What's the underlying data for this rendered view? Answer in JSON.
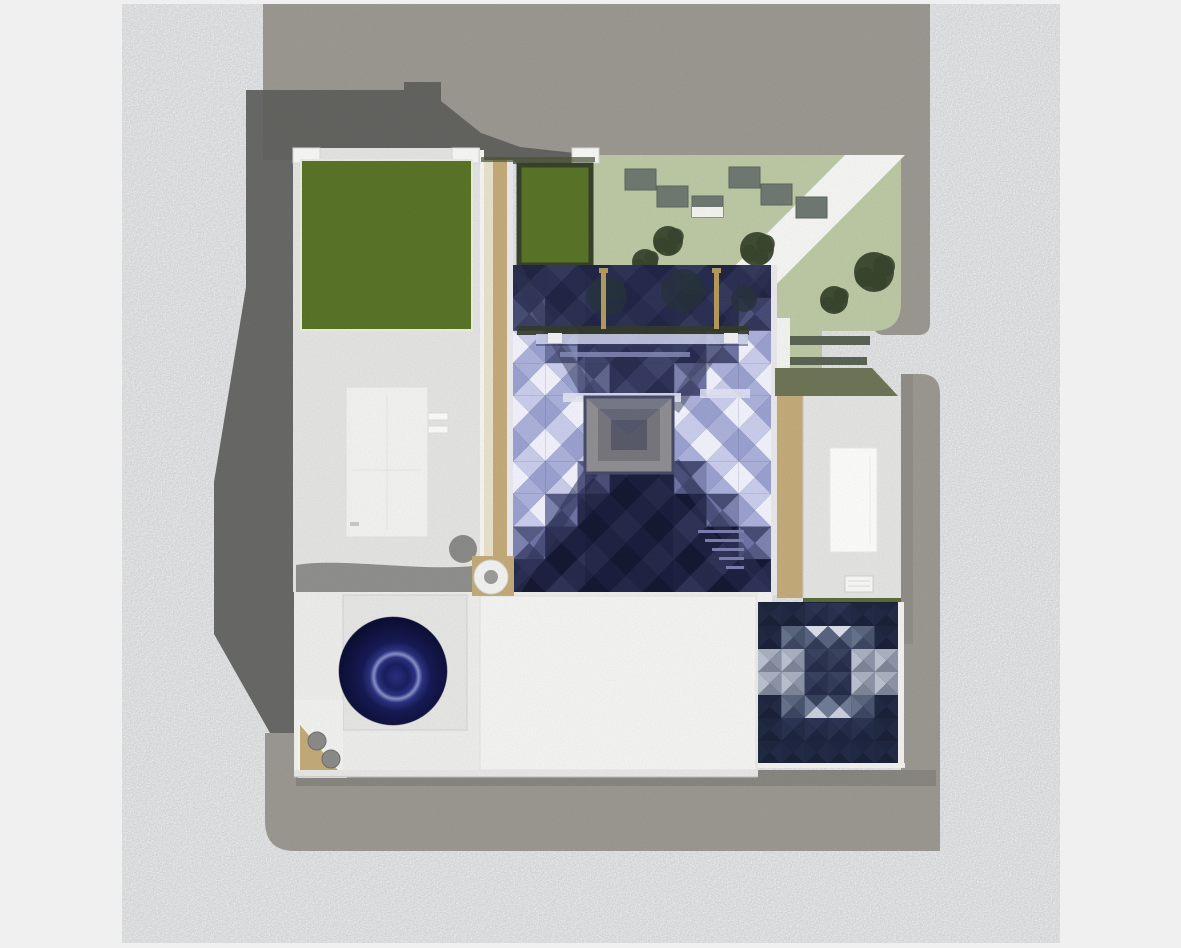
{
  "scene": {
    "description": "aerial-top-down-architectural-render",
    "frame_color": "#f0f0f1",
    "ground_color": "#d3d5d7",
    "road_color": "#9b9791",
    "shadow_color": "#5f5f5c",
    "roof_shadow_color": "#8f8f8d",
    "under_building_shadow": "#85827c"
  },
  "site": {
    "lawn_color": "#bcc8a4",
    "green_roof_color": "#597428",
    "hedge_color": "#38422a",
    "roof_light": "#e3e3e1",
    "roof_white": "#f3f3f1",
    "roof_mid": "#ececea",
    "slab_gray": "#e5e5e3",
    "tan": "#c3aa79",
    "cream": "#e7e0ca",
    "olive": "#6e7557",
    "paver": "#6f7971",
    "paver_edge": "#5d675f",
    "tree": "#39462e",
    "courtyard_tree": "#27333c",
    "path_white": "#f4f4f2",
    "panel_white": "#fbfbfa",
    "panel_inset": "#f1f1ef",
    "lamp_post_tan": "#b59a5f",
    "bench_bar": "#5b6354",
    "green_hairline": "#5a6b3a",
    "pebble": "#8b8b89",
    "vent_white": "#f1f1ef",
    "vent_hole": "#9c9c9a",
    "dome_navy": "#1b2064",
    "parapet_white": "#f6f6f4"
  },
  "pyramid": {
    "bg": "#222648",
    "top_band_tint": "#1a1e3e",
    "palette": {
      "W": [
        "#c9cdeb",
        "#9ba1cf",
        "#abb1da",
        "#f0f1fa"
      ],
      "E": [
        "#c9cdeb",
        "#f0f1fa",
        "#abb1da",
        "#9ba1cf"
      ],
      "N": [
        "#282c4e",
        "#3b4066",
        "#4b5078",
        "#33375c"
      ],
      "S": [
        "#151933",
        "#272b4c",
        "#2f3458",
        "#1e2242"
      ],
      "D": [
        "#575c86",
        "#6e74a4",
        "#484d76",
        "#7e84b0"
      ]
    },
    "center_square": {
      "outer": "#8f8f93",
      "mid": "#76767c",
      "inner": "#595b6b",
      "edge": "#474b68"
    },
    "beam_light": "#c9cde7",
    "beam_white": "#e2e4f2",
    "stair_line": "#7a80ac"
  },
  "star_patch": {
    "bg": "#1c2338",
    "matrix": [
      "ddffdd",
      "dsaasd",
      "llxxll",
      "llxxll",
      "dsAAsd",
      "dffffd",
      "dddddd"
    ],
    "palette": {
      "d": [
        "#1f2740",
        "#232b46",
        "#1b2238",
        "#212a44"
      ],
      "f": [
        "#2c3554",
        "#242c48",
        "#1e2540",
        "#293150"
      ],
      "s": [
        "#5a6580",
        "#49546e",
        "#3e4762",
        "#67728c"
      ],
      "a": [
        "#d9dee9",
        "#596480",
        "#333c56",
        "#596480"
      ],
      "A": [
        "#39425c",
        "#707c96",
        "#c9d0dc",
        "#707c96"
      ],
      "l": [
        "#a9b1c1",
        "#8c95a7",
        "#7d8697",
        "#bac1cf"
      ],
      "x": [
        "#3a4360",
        "#2c3450",
        "#252d4a",
        "#343d5a"
      ]
    }
  }
}
